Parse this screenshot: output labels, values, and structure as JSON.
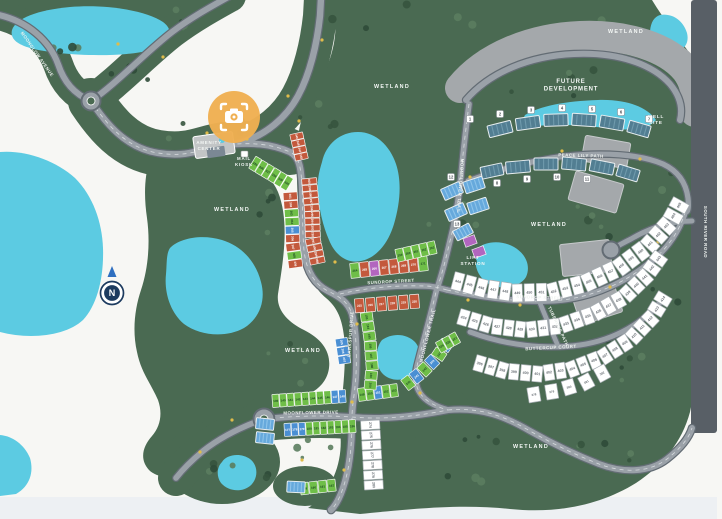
{
  "map_type": "community-site-plan",
  "colors": {
    "background": "#f7f7f4",
    "bottom_strip": "#edf0f3",
    "green": "#4a6a52",
    "tree_dark": "#36543e",
    "tree_darker": "#2f4b38",
    "tree_light": "#5b7d5f",
    "water": "#5ccbe2",
    "road_fill": "#9aa1a8",
    "road_casing": "#636c74",
    "road_dash": "#d7dbde",
    "future_gray": "#a4a8ab",
    "band_gray": "#585f66",
    "band_text": "#a9b2b9",
    "lot_red": "#c3593c",
    "lot_green": "#6fbe48",
    "lot_blue": "#4a8fd3",
    "lot_purple": "#b266bf",
    "lot_white": "#ffffff",
    "lot_white_stroke": "#a6adb2",
    "lot_white_text": "#6a7076",
    "lot_green_text": "#1d4a24",
    "townhome_teal": "#527e92",
    "townhome_teal_stripe": "#6f9aac",
    "townhome_blue": "#66a9dc",
    "townhome_blue_stripe": "#8ec4ea",
    "camera_marker": "#f0b052",
    "compass_navy": "#1d3b5f",
    "compass_arrow": "#2f6fc0",
    "accent_dot": "#e0bc4b"
  },
  "region_labels": [
    {
      "text": "WETLAND",
      "x": 392,
      "y": 88
    },
    {
      "text": "WETLAND",
      "x": 626,
      "y": 33
    },
    {
      "text": "WETLAND",
      "x": 232,
      "y": 211
    },
    {
      "text": "WETLAND",
      "x": 303,
      "y": 352
    },
    {
      "text": "WETLAND",
      "x": 549,
      "y": 226
    },
    {
      "text": "WETLAND",
      "x": 531,
      "y": 448
    }
  ],
  "area_labels": [
    {
      "id": "future-development",
      "lines": [
        "FUTURE",
        "DEVELOPMENT"
      ],
      "x": 571,
      "y": 83,
      "size": 6
    },
    {
      "id": "well-site",
      "lines": [
        "WELL",
        "SITE"
      ],
      "x": 656,
      "y": 118,
      "size": 4.6
    },
    {
      "id": "amenity-center",
      "lines": [
        "AMENITY",
        "CENTER"
      ],
      "x": 209,
      "y": 144,
      "size": 4.4
    },
    {
      "id": "mail-kiosk",
      "lines": [
        "MAIL",
        "KIOSK"
      ],
      "x": 244,
      "y": 160,
      "size": 4.4
    },
    {
      "id": "lift-station",
      "lines": [
        "LIFT",
        "STATION"
      ],
      "x": 473,
      "y": 259,
      "size": 4.6
    }
  ],
  "street_labels": [
    {
      "text": "MOONGLOW AVENUE",
      "x": 36,
      "y": 55,
      "rot": 55
    },
    {
      "text": "SUNDROP STREET",
      "x": 391,
      "y": 283,
      "rot": -3
    },
    {
      "text": "SUNDROP STREET",
      "x": 540,
      "y": 299,
      "rot": 2
    },
    {
      "text": "TUBEROSE PATH",
      "x": 557,
      "y": 327,
      "rot": 65
    },
    {
      "text": "BUTTERCUP COURT",
      "x": 551,
      "y": 349,
      "rot": -3
    },
    {
      "text": "MOONFLOWER DRIVE",
      "x": 311,
      "y": 414,
      "rot": -1
    },
    {
      "text": "MOONFLOWER TRAIL",
      "x": 459,
      "y": 186,
      "rot": 94
    },
    {
      "text": "MOONFLOWER TRAIL",
      "x": 429,
      "y": 336,
      "rot": -76
    },
    {
      "text": "LARKSPUR DRIVE",
      "x": 352,
      "y": 334,
      "rot": -86
    },
    {
      "text": "PEACE LILY PATH",
      "x": 581,
      "y": 157,
      "rot": 2
    },
    {
      "text": "SOUTH RIVER ROAD",
      "x": 704,
      "y": 232,
      "rot": 90
    }
  ],
  "markers": {
    "camera_view": {
      "x": 234,
      "y": 117,
      "r": 26
    },
    "compass": {
      "x": 112,
      "y": 293,
      "letter": "N"
    },
    "building_numbers": [
      {
        "n": 1,
        "x": 470,
        "y": 119
      },
      {
        "n": 2,
        "x": 500,
        "y": 114
      },
      {
        "n": 3,
        "x": 531,
        "y": 110
      },
      {
        "n": 4,
        "x": 562,
        "y": 108
      },
      {
        "n": 5,
        "x": 592,
        "y": 109
      },
      {
        "n": 6,
        "x": 621,
        "y": 112
      },
      {
        "n": 7,
        "x": 649,
        "y": 119
      },
      {
        "n": 8,
        "x": 497,
        "y": 183
      },
      {
        "n": 9,
        "x": 527,
        "y": 179
      },
      {
        "n": 10,
        "x": 557,
        "y": 177
      },
      {
        "n": 11,
        "x": 587,
        "y": 179
      },
      {
        "n": 12,
        "x": 451,
        "y": 177
      },
      {
        "n": 13,
        "x": 457,
        "y": 224
      }
    ]
  },
  "lift_parcels": [
    [
      470,
      241,
      12,
      9,
      -20
    ],
    [
      479,
      252,
      12,
      9,
      -20
    ]
  ],
  "lot_clusters": [
    {
      "name": "kiosk-green-row",
      "nums": [
        335,
        336,
        337,
        338,
        339,
        340
      ],
      "colors": "gggggg",
      "pts": [
        [
          252,
          162
        ],
        [
          290,
          185
        ]
      ],
      "lw": 6.8,
      "ld": 14
    },
    {
      "name": "avenue-red-column",
      "nums": [
        345,
        346,
        347,
        348
      ],
      "colors": "rrrr",
      "pts": [
        [
          296,
          133
        ],
        [
          302,
          160
        ]
      ],
      "lw": 6.4,
      "ld": 13
    },
    {
      "name": "snake-east-column",
      "nums": [
        300,
        299,
        298,
        297,
        296,
        295,
        294,
        293,
        292,
        291,
        290,
        289,
        288
      ],
      "colors": "rrrrrrrrrrrrr",
      "pts": [
        [
          309,
          178
        ],
        [
          312,
          210
        ],
        [
          313,
          240
        ],
        [
          318,
          264
        ]
      ],
      "lw": 6,
      "ld": 15
    },
    {
      "name": "snake-west-column",
      "nums": [
        301,
        302,
        303,
        304,
        305,
        306,
        307,
        308,
        309
      ],
      "colors": "rrggbrrgr",
      "pts": [
        [
          290,
          192
        ],
        [
          292,
          220
        ],
        [
          293,
          246
        ],
        [
          296,
          268
        ]
      ],
      "lw": 7.8,
      "ld": 14
    },
    {
      "name": "sundrop-north-row",
      "nums": [
        264,
        265,
        266,
        267,
        268,
        269,
        270,
        271
      ],
      "colors": "grprrrrg",
      "pts": [
        [
          350,
          271
        ],
        [
          428,
          263
        ]
      ],
      "lw": 9,
      "ld": 15
    },
    {
      "name": "sundrop-south-row",
      "nums": [
        215,
        216,
        217,
        218,
        219,
        220
      ],
      "colors": "rrrrrr",
      "pts": [
        [
          354,
          306
        ],
        [
          420,
          301
        ]
      ],
      "lw": 9.2,
      "ld": 14
    },
    {
      "name": "northeast-green-row",
      "nums": [
        259,
        260,
        261,
        262,
        263
      ],
      "colors": "ggggg",
      "pts": [
        [
          396,
          256
        ],
        [
          436,
          247
        ]
      ],
      "lw": 7.6,
      "ld": 13
    },
    {
      "name": "moonflower-north-row",
      "nums": [
        139,
        140,
        141,
        142,
        143,
        144,
        145,
        146,
        147,
        148
      ],
      "colors": "ggggggggbb",
      "pts": [
        [
          272,
          401
        ],
        [
          346,
          396
        ]
      ],
      "lw": 6.8,
      "ld": 13
    },
    {
      "name": "moonflower-north-row-east",
      "nums": [
        149,
        150,
        151,
        152,
        153
      ],
      "colors": "ggbgg",
      "pts": [
        [
          358,
          395
        ],
        [
          398,
          390
        ]
      ],
      "lw": 7.4,
      "ld": 13
    },
    {
      "name": "trail-row",
      "nums": [
        240,
        241,
        242,
        243,
        244,
        245
      ],
      "colors": "gbgbgb",
      "pts": [
        [
          404,
          386
        ],
        [
          422,
          372
        ],
        [
          438,
          356
        ],
        [
          448,
          341
        ]
      ],
      "lw": 9,
      "ld": 13
    },
    {
      "name": "moonflower-south-row",
      "nums": [
        177,
        178,
        179,
        180,
        181,
        182,
        183,
        184,
        185,
        186
      ],
      "colors": "bbbggggggg",
      "pts": [
        [
          284,
          430
        ],
        [
          356,
          426
        ]
      ],
      "lw": 6.6,
      "ld": 13
    },
    {
      "name": "moonflower-south-row-2",
      "nums": [
        189,
        190,
        191,
        192
      ],
      "colors": "gggg",
      "pts": [
        [
          300,
          489
        ],
        [
          336,
          485
        ]
      ],
      "lw": 8.2,
      "ld": 12
    },
    {
      "name": "white-column",
      "nums": [
        274,
        275,
        276,
        277,
        278,
        279,
        280
      ],
      "colors": "wwwwwww",
      "pts": [
        [
          370,
          420
        ],
        [
          374,
          490
        ]
      ],
      "lw": 9,
      "ld": 19
    },
    {
      "name": "mid-green-east",
      "nums": [
        193,
        194,
        195,
        196,
        197,
        198,
        199,
        200
      ],
      "colors": "gggggggg",
      "pts": [
        [
          366,
          312
        ],
        [
          370,
          340
        ],
        [
          372,
          366
        ],
        [
          370,
          390
        ]
      ],
      "lw": 9,
      "ld": 12
    },
    {
      "name": "blue-column",
      "nums": [
        205,
        206,
        207
      ],
      "colors": "bbb",
      "pts": [
        [
          341,
          338
        ],
        [
          345,
          364
        ]
      ],
      "lw": 8,
      "ld": 12
    },
    {
      "name": "green-wedge",
      "nums": [
        225,
        226,
        227
      ],
      "colors": "ggg",
      "pts": [
        [
          438,
          348
        ],
        [
          458,
          337
        ]
      ],
      "lw": 7,
      "ld": 12
    },
    {
      "name": "fan-row-north",
      "nums": [
        444,
        445,
        446,
        447,
        448,
        449,
        450,
        451,
        452,
        453,
        454,
        455,
        456,
        457,
        458,
        459,
        460,
        461,
        462,
        463,
        464,
        465
      ],
      "colors": "wwwwwwwwwwwwwwwwwwwwww",
      "pts": [
        [
          452,
          280
        ],
        [
          482,
          288
        ],
        [
          516,
          293
        ],
        [
          552,
          292
        ],
        [
          586,
          283
        ],
        [
          620,
          267
        ],
        [
          648,
          246
        ],
        [
          670,
          222
        ],
        [
          682,
          200
        ]
      ],
      "lw": 10.2,
      "ld": 18
    },
    {
      "name": "fan-row-middle",
      "nums": [
        424,
        425,
        426,
        427,
        428,
        429,
        430,
        431,
        432,
        433,
        434,
        435,
        436,
        437,
        438,
        439,
        440,
        441,
        442,
        443
      ],
      "colors": "wwwwwwwwwwwwwwwwwwww",
      "pts": [
        [
          458,
          316
        ],
        [
          492,
          326
        ],
        [
          526,
          330
        ],
        [
          560,
          326
        ],
        [
          594,
          314
        ],
        [
          624,
          297
        ],
        [
          646,
          276
        ],
        [
          662,
          254
        ]
      ],
      "lw": 10,
      "ld": 16
    },
    {
      "name": "fan-row-south",
      "nums": [
        396,
        397,
        398,
        399,
        400,
        401,
        402,
        403,
        404,
        405,
        406,
        407,
        408,
        409,
        410,
        411,
        412,
        413,
        414
      ],
      "colors": "wwwwwwwwwwwwwwwwwww",
      "pts": [
        [
          474,
          362
        ],
        [
          505,
          371
        ],
        [
          538,
          374
        ],
        [
          572,
          369
        ],
        [
          603,
          357
        ],
        [
          631,
          339
        ],
        [
          652,
          317
        ],
        [
          666,
          294
        ]
      ],
      "lw": 10,
      "ld": 16
    },
    {
      "name": "fan-row-lower",
      "nums": [
        378,
        379,
        380,
        381,
        382
      ],
      "colors": "wwwww",
      "pts": [
        [
          525,
          396
        ],
        [
          556,
          391
        ],
        [
          586,
          382
        ],
        [
          610,
          369
        ]
      ],
      "lw": 12,
      "ld": 15
    }
  ],
  "buildings": {
    "teal": [
      [
        500,
        129,
        24,
        12,
        -14
      ],
      [
        528,
        123,
        24,
        12,
        -8
      ],
      [
        556,
        120,
        24,
        12,
        -2
      ],
      [
        584,
        120,
        24,
        12,
        4
      ],
      [
        612,
        123,
        24,
        12,
        10
      ],
      [
        639,
        129,
        22,
        12,
        16
      ],
      [
        492,
        171,
        22,
        12,
        -12
      ],
      [
        518,
        167,
        24,
        12,
        -5
      ],
      [
        546,
        164,
        24,
        12,
        0
      ],
      [
        574,
        164,
        24,
        12,
        5
      ],
      [
        602,
        167,
        24,
        12,
        11
      ],
      [
        628,
        173,
        22,
        12,
        17
      ]
    ],
    "light_blue": [
      [
        452,
        191,
        20,
        12,
        -24
      ],
      [
        474,
        185,
        20,
        12,
        -18
      ],
      [
        456,
        212,
        20,
        12,
        -24
      ],
      [
        478,
        206,
        20,
        12,
        -18
      ],
      [
        463,
        232,
        18,
        11,
        -28
      ],
      [
        265,
        424,
        18,
        11,
        6
      ],
      [
        265,
        438,
        18,
        11,
        6
      ],
      [
        296,
        487,
        18,
        11,
        3
      ]
    ]
  }
}
